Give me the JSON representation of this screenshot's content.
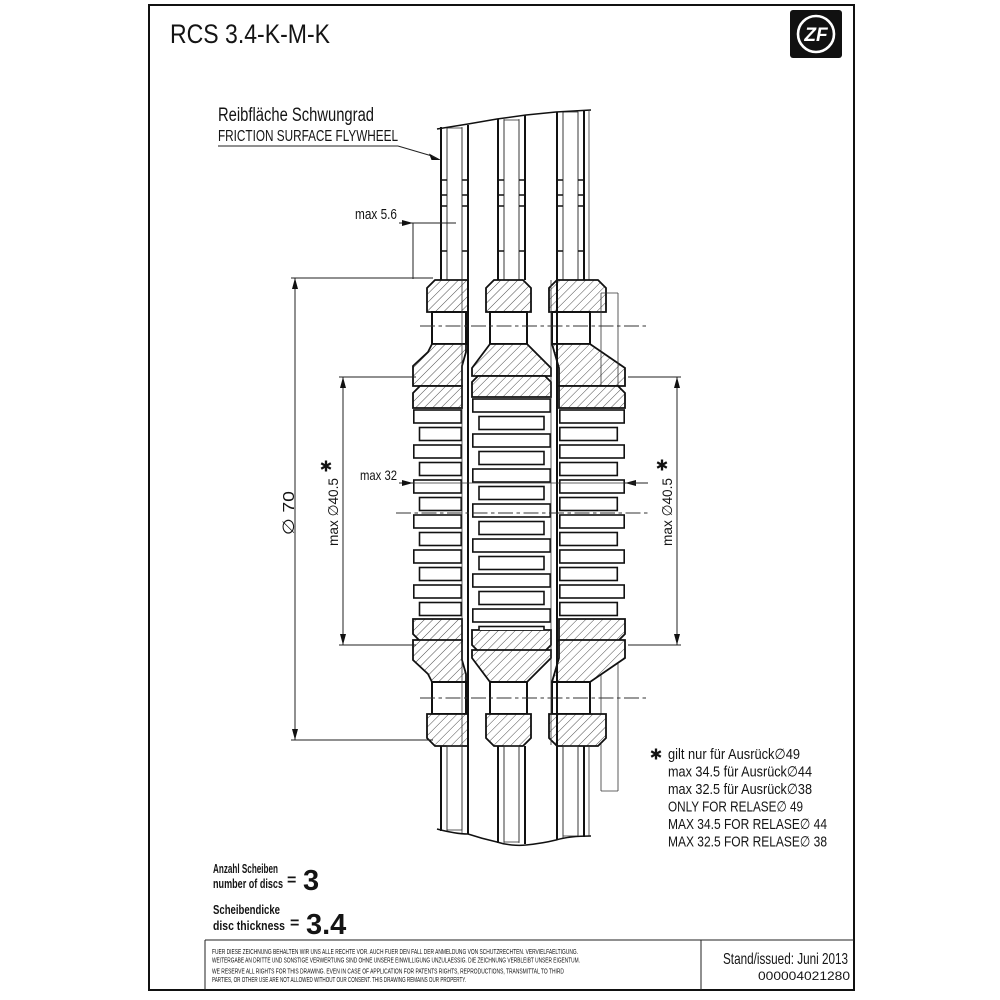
{
  "sheet": {
    "title": "RCS 3.4-K-M-K",
    "logo_text": "ZF",
    "stand_issued": "Stand/issued: Juni 2013",
    "doc_number": "000004021280"
  },
  "labels": {
    "friction_de": "Reibfläche Schwungrad",
    "friction_en": "FRICTION SURFACE FLYWHEEL"
  },
  "dimensions": {
    "max_5_6": "max 5.6",
    "dia_70": "∅ 70",
    "max_dia_40_5": "max ∅40.5",
    "max_32": "max 32",
    "footnote_marker": "*"
  },
  "notes": {
    "marker": "*",
    "lines": [
      "gilt nur für Ausrück∅49",
      "max 34.5 für Ausrück∅44",
      "max 32.5 für Ausrück∅38",
      "ONLY FOR RELASE∅ 49",
      "MAX 34.5 FOR RELASE∅ 44",
      "MAX 32.5 FOR RELASE∅ 38"
    ]
  },
  "specs": {
    "discs_de": "Anzahl Scheiben",
    "discs_en": "number of discs",
    "discs_eq": "=",
    "discs_value": "3",
    "thickness_de": "Scheibendicke",
    "thickness_en": "disc thickness",
    "thickness_eq": "=",
    "thickness_value": "3.4"
  },
  "legal": {
    "de1": "FUER DIESE ZEICHNUNG BEHALTEN WIR UNS ALLE RECHTE VOR. AUCH FUER DEN FALL DER ANMELDUNG VON SCHUTZRECHTEN. VERVIELFAELTIGUNG.",
    "de2": "WEITERGABE AN DRITTE UND SONSTIGE VERWERTUNG SIND OHNE UNSERE EINWILLIGUNG UNZULAESSIG. DIE ZEICHNUNG VERBLEIBT UNSER EIGENTUM.",
    "en1": "WE RESERVE ALL RIGHTS FOR THIS DRAWING. EVEN IN CASE OF APPLICATION FOR PATENTS RIGHTS, REPRODUCTIONS, TRANSMITTAL TO THIRD",
    "en2": "PARTIES, OR OTHER USE ARE NOT ALLOWED WITHOUT OUR CONSENT. THIS DRAWING REMAINS OUR PROPERTY."
  },
  "colors": {
    "ink": "#141414",
    "paper": "#ffffff"
  }
}
